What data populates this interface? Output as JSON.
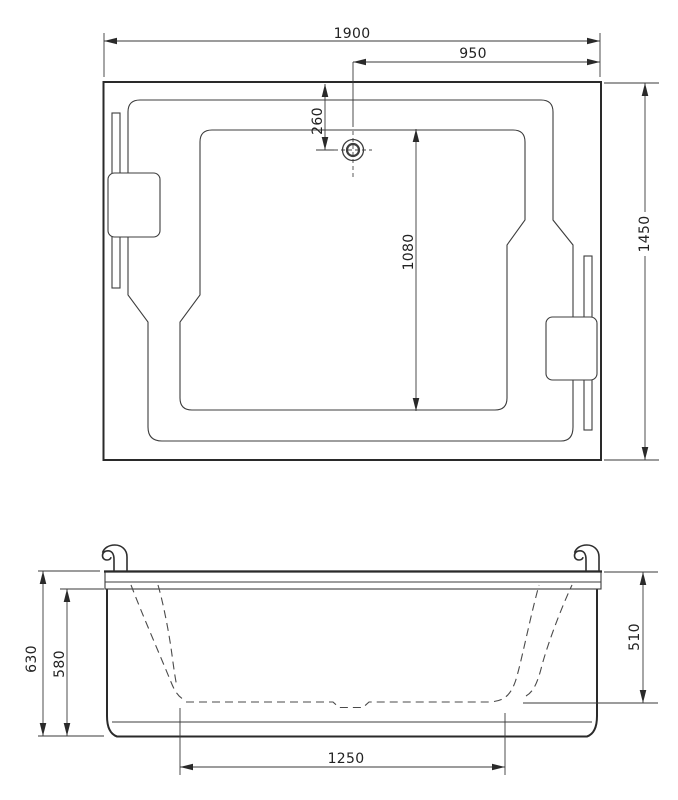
{
  "app": {
    "background": "#ffffff",
    "line_color": "#3a3a3a",
    "text_color": "#222222"
  },
  "top_view": {
    "name": "plan-view",
    "dimensions": {
      "overall_length": "1900",
      "center_to_end": "950",
      "edge_to_drain": "260",
      "basin_length": "1080",
      "overall_width": "1450"
    }
  },
  "front_view": {
    "name": "front-elevation",
    "dimensions": {
      "overall_height": "630",
      "apron_height": "580",
      "inner_depth": "510",
      "basin_base_length": "1250"
    }
  }
}
